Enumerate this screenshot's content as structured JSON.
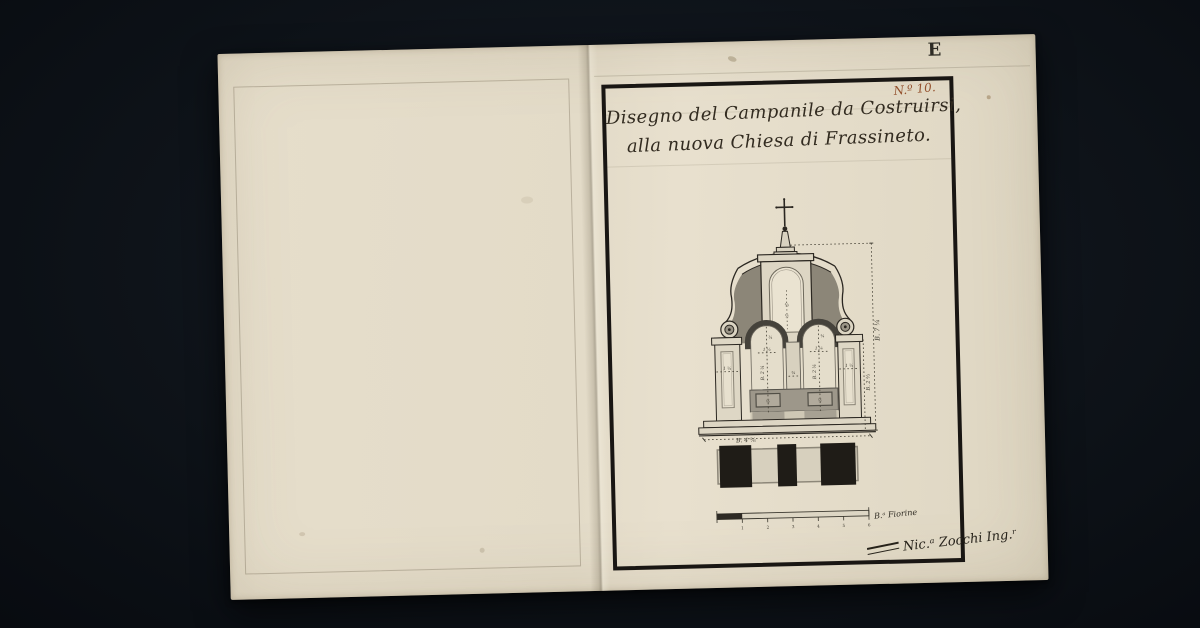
{
  "document": {
    "plate_letter": "E",
    "folio_number": "N.º 10.",
    "title_line1": "Disegno del Campanile da Costruirsi,",
    "title_line2": "alla nuova Chiesa di Frassineto.",
    "signature": "Nic.ᵃ Zocchi Ing.ʳ"
  },
  "drawing": {
    "subject": "Ink-and-wash elevation of a bell-gable campanile: cross finial, volute pediment with central niche, two arched bell openings, stepped base, plan strip and graphic scale below",
    "dimensions": {
      "overall_height": "B. 7 ¼",
      "body_height": "B. 2 ⅔",
      "base_width": "B. 4 ⅚",
      "arch_left": "B. 2 ¼",
      "arch_right": "B. 2 ¼",
      "arch_left_top": "¾",
      "arch_right_top": "¾",
      "arch_left_width": "1 ¼",
      "arch_right_width": "1 ¼",
      "pier_width": "¾",
      "pilaster_left": "1 ¼",
      "pilaster_right": "1 ¼",
      "parapet_left": "½",
      "parapet_right": "½",
      "niche_upper": "⅔",
      "niche_lower": "½"
    }
  },
  "scale_bar": {
    "ticks": [
      "1",
      "2",
      "3",
      "4",
      "5",
      "6"
    ],
    "unit_label": "B.ᵃ Fiorine"
  },
  "colors": {
    "background": "#0e1319",
    "paper": "#e3dbc8",
    "ink": "#2b2721",
    "red_ink": "#94512e",
    "wash_dark": "#45423b",
    "wash_mid": "#8c8678",
    "wash_light": "#d9d2c0"
  }
}
